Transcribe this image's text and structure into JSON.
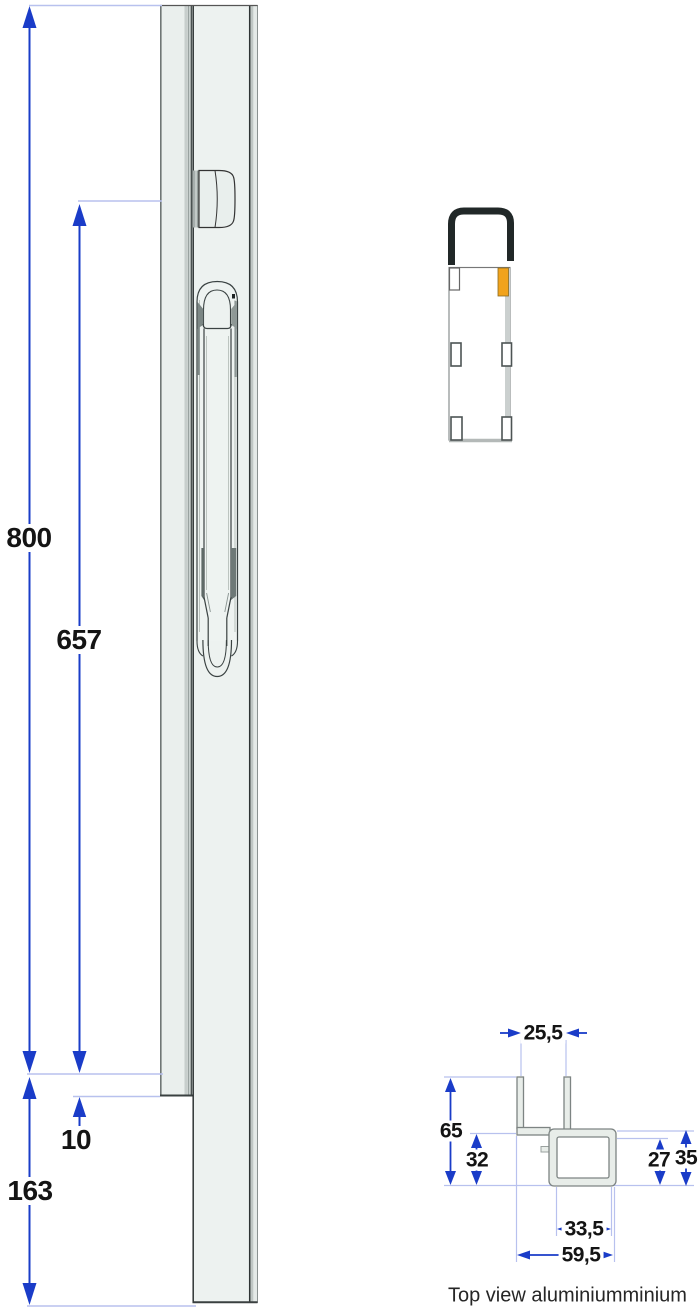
{
  "front_view": {
    "description": "Side view of aluminium locking post with espagnolette handle",
    "dims": {
      "total_height": "800",
      "rod_length": "657",
      "offset": "10",
      "bottom_section": "163"
    }
  },
  "section_view": {
    "description": "Lock body with hook and orange keeper marker"
  },
  "top_view": {
    "caption": "Top view aluminiumminium",
    "dims": {
      "channel_width": "25,5",
      "overall_height": "65",
      "inner_height": "32",
      "tube_inner_height": "27",
      "tube_outer_height": "35",
      "tube_inner_width": "33,5",
      "overall_width": "59,5"
    }
  },
  "colors": {
    "dimension_blue": "#1a3cc8",
    "extension_line": "#b8c1ee",
    "profile_fill": "#eaefed",
    "highlight_orange": "#f1a31c",
    "label_text": "#141414"
  }
}
